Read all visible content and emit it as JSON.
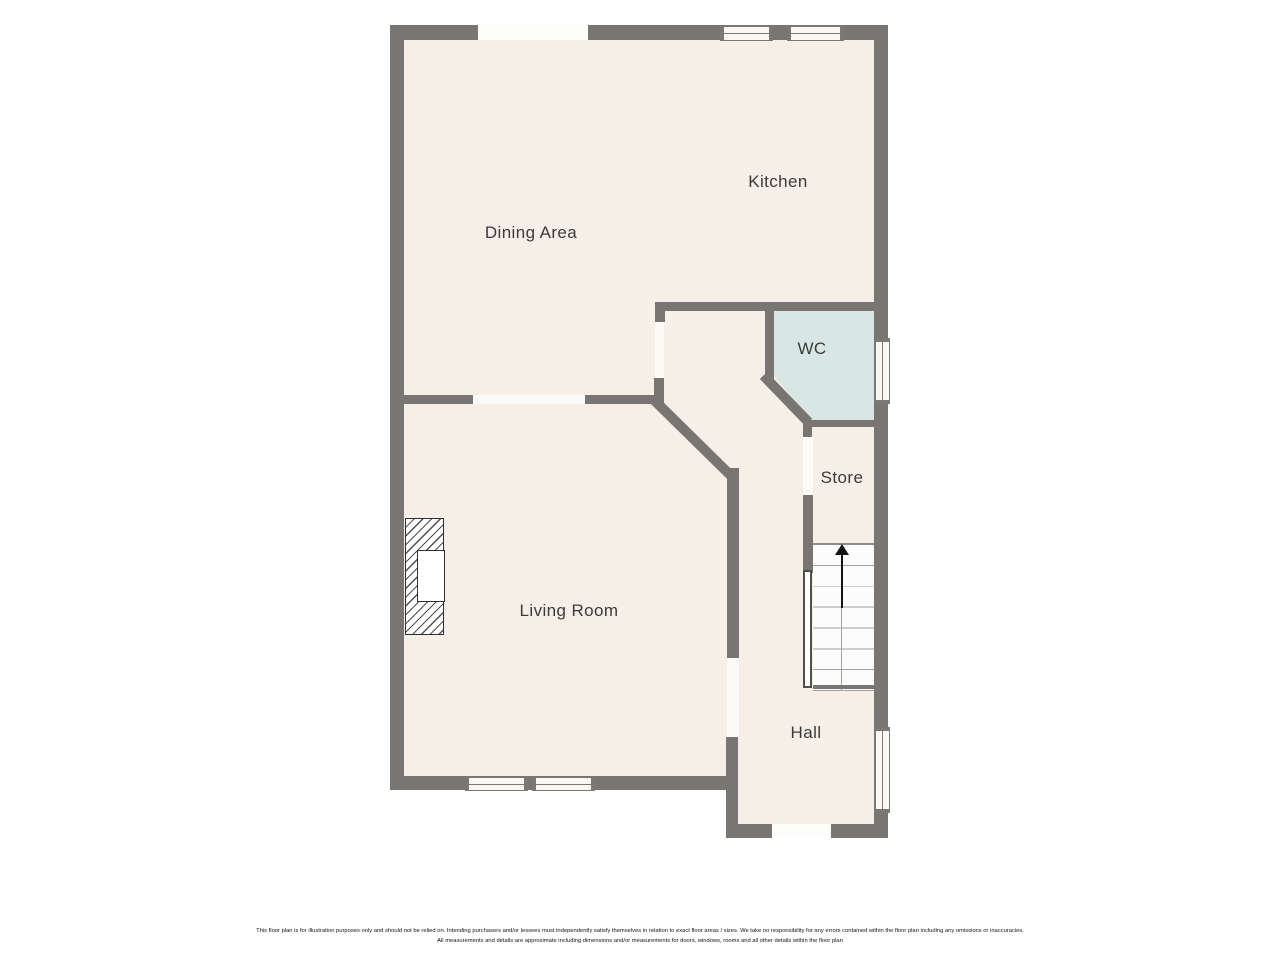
{
  "plan": {
    "type": "residential-floor-plan",
    "rooms": [
      {
        "id": "dining",
        "label": "Dining Area"
      },
      {
        "id": "kitchen",
        "label": "Kitchen"
      },
      {
        "id": "wc",
        "label": "WC"
      },
      {
        "id": "store",
        "label": "Store"
      },
      {
        "id": "living",
        "label": "Living Room"
      },
      {
        "id": "hall",
        "label": "Hall"
      }
    ],
    "features": {
      "stairs": {
        "steps": 7,
        "direction": "up",
        "icon": "up-arrow-icon"
      },
      "fireplace": {
        "location": "living-room-left-wall"
      },
      "windows": 7,
      "door_openings": 6
    }
  },
  "colors": {
    "page_bg": "#ffffff",
    "floor": "#f5efe7",
    "wall": "#797572",
    "wc_floor": "#d9e7e4",
    "window_fill": "#faf7f2",
    "window_line": "#7b7974",
    "label": "#3b3b3b"
  },
  "disclaimer": {
    "line1": "This floor plan is for illustration purposes only and should not be relied on. Intending purchasers and/or lessees must independently satisfy themselves in relation to exact floor areas / sizes. We take no responsibility for any errors contained within the floor plan including any omissions or inaccuracies.",
    "line2": "All measurements and details are approximate including dimensions and/or measurements for doors, windows, rooms and all other details within the floor plan"
  }
}
